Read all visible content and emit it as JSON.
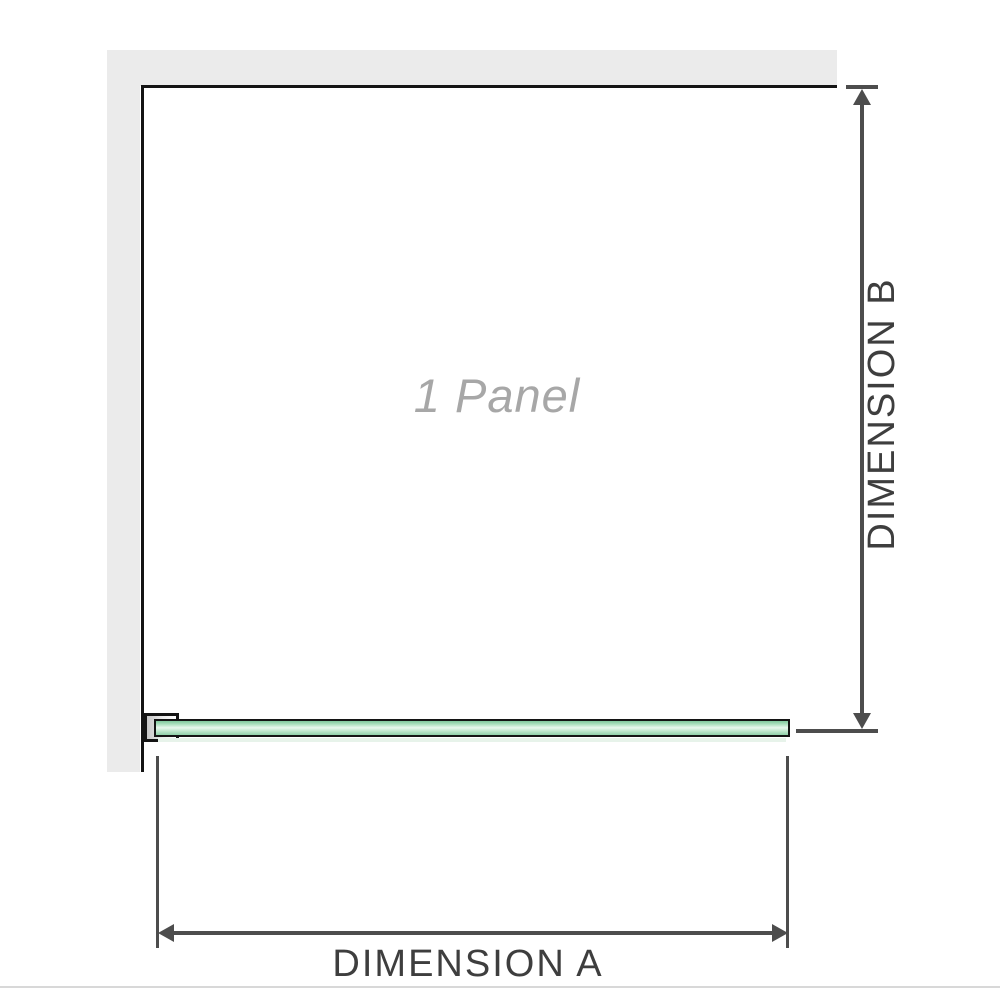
{
  "diagram": {
    "panel_label": "1 Panel",
    "dimension_a_label": "DIMENSION A",
    "dimension_b_label": "DIMENSION B",
    "colors": {
      "wall": "#ebebeb",
      "outline": "#141414",
      "dimension_lines": "#4d4d4d",
      "glass_green": "#8fd0a8",
      "glass_highlight": "#e9f8ee",
      "panel_label_gray": "#a7a7a7",
      "dimension_text": "#3e3e3e",
      "bottom_divider": "#d8d8d8"
    }
  }
}
